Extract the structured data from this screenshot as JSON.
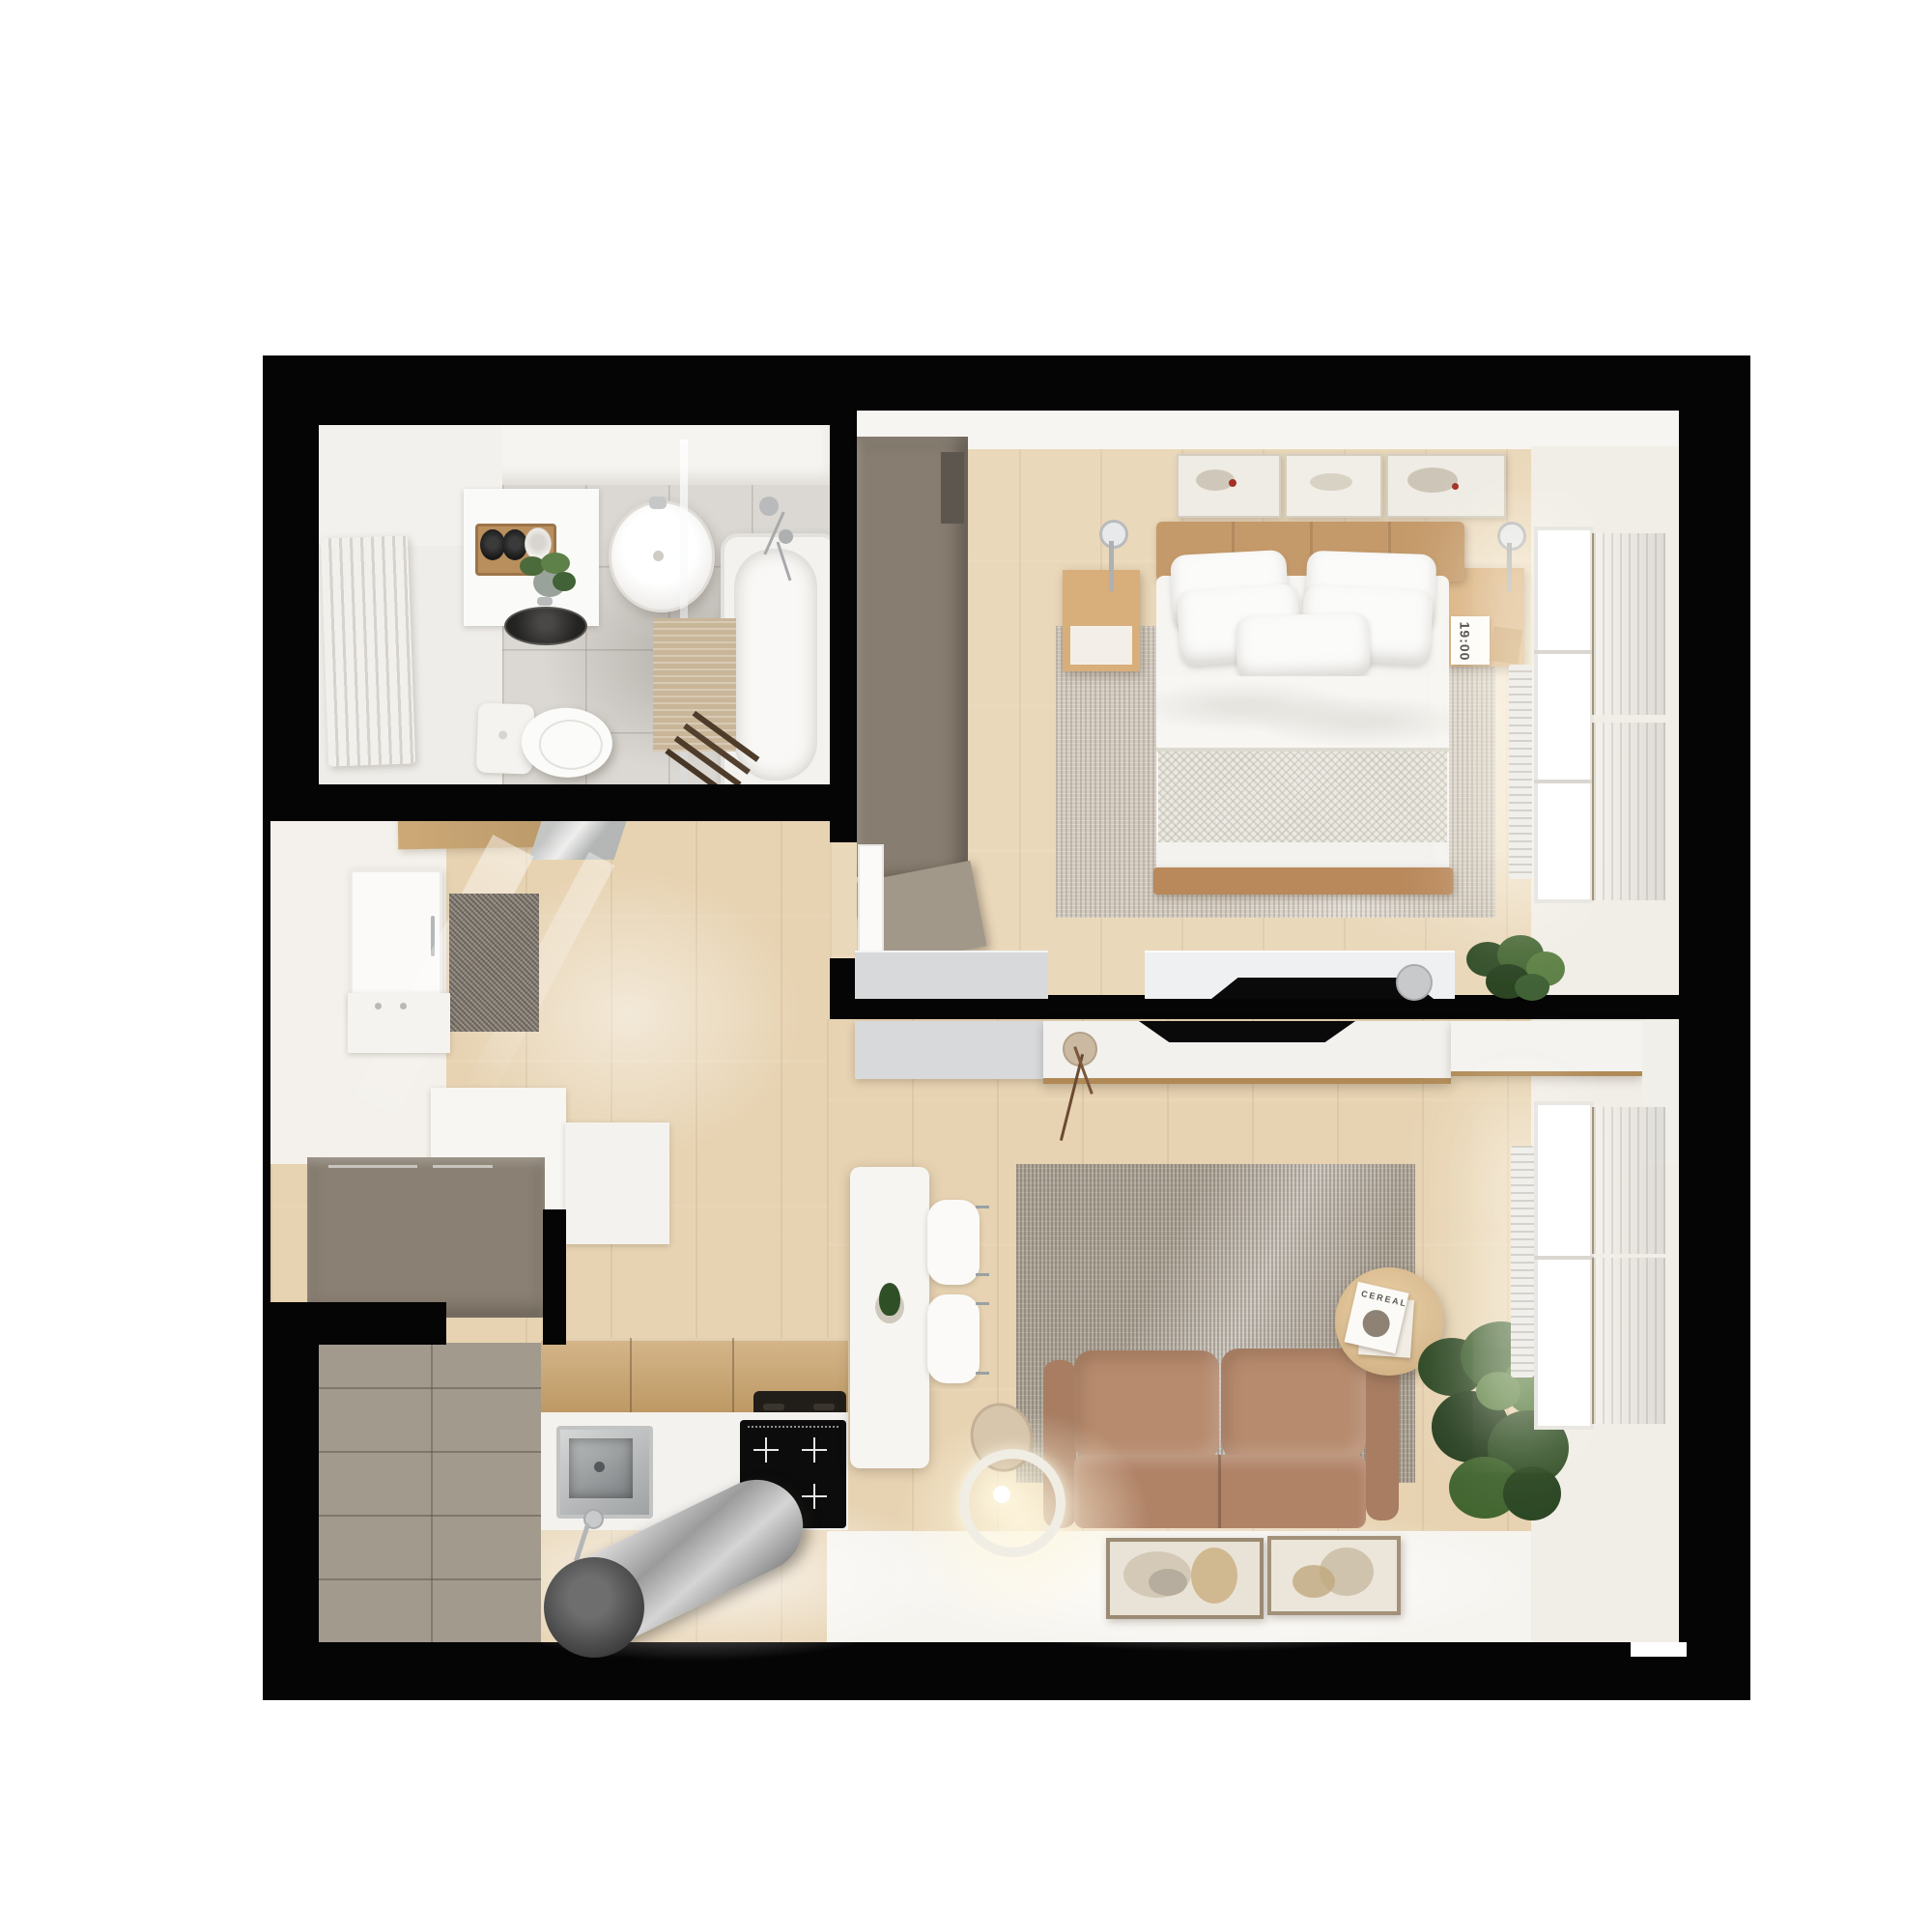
{
  "scene": {
    "type": "3d-rendered-apartment-floor-plan-top-view",
    "background_color": "#ffffff",
    "wall_color": "#050505",
    "palette": {
      "wood_floor": "#e7d3b2",
      "bedroom_floor": "#ead8ba",
      "bath_tile": "#dbd8d3",
      "taupe_cabinet": "#8a8073",
      "kitchen_cabinet": "#a29a8d",
      "sofa": "#b78b6e",
      "bed_frame": "#c59a6a",
      "nightstand_oak": "#d8ae7b",
      "rug_bedroom": "#d2cabf",
      "rug_living": "#b1a89b",
      "curtain": "#c3b199",
      "plant_green": "#3a5c2d",
      "stainless": "#b9bcbd"
    },
    "texts": {
      "clock": "19:00",
      "magazine_title": "CEREAL"
    },
    "rooms": [
      {
        "name": "bathroom",
        "items": [
          "radiator",
          "vanity",
          "toilet-paper-shelf",
          "plant",
          "vessel-sink",
          "round-washbasin",
          "glass-screen",
          "bathtub",
          "shower-mixer",
          "toilet",
          "bath-mat",
          "towel-ladder"
        ]
      },
      {
        "name": "bedroom",
        "items": [
          "wardrobe",
          "open-wardrobe-door",
          "art-frames",
          "headboard",
          "double-bed",
          "pillows",
          "duvet",
          "throw-blanket",
          "nightstand-left",
          "nightstand-right",
          "pendant-lamp-left",
          "pendant-lamp-right",
          "alarm-clock",
          "rug",
          "dresser",
          "tv",
          "corner-plant",
          "window",
          "curtains",
          "radiator"
        ]
      },
      {
        "name": "hallway",
        "items": [
          "entrance-door",
          "coat-shelf",
          "mirror",
          "doormat",
          "shoe-cabinet",
          "entry-closet",
          "closet-counter"
        ]
      },
      {
        "name": "kitchen",
        "items": [
          "tall-cabinets",
          "wood-counter",
          "tray",
          "white-counter",
          "sink",
          "faucet",
          "induction-hob",
          "extractor-hood"
        ]
      },
      {
        "name": "living-room",
        "items": [
          "tv-console",
          "tv",
          "branch-vase",
          "sideboard",
          "corner-cabinets",
          "dining-table",
          "green-vase",
          "chairs",
          "rug",
          "sofa",
          "coffee-table",
          "magazines",
          "floor-lamp",
          "art-frames-on-floor",
          "large-plant",
          "window",
          "curtains",
          "radiator"
        ]
      }
    ]
  }
}
